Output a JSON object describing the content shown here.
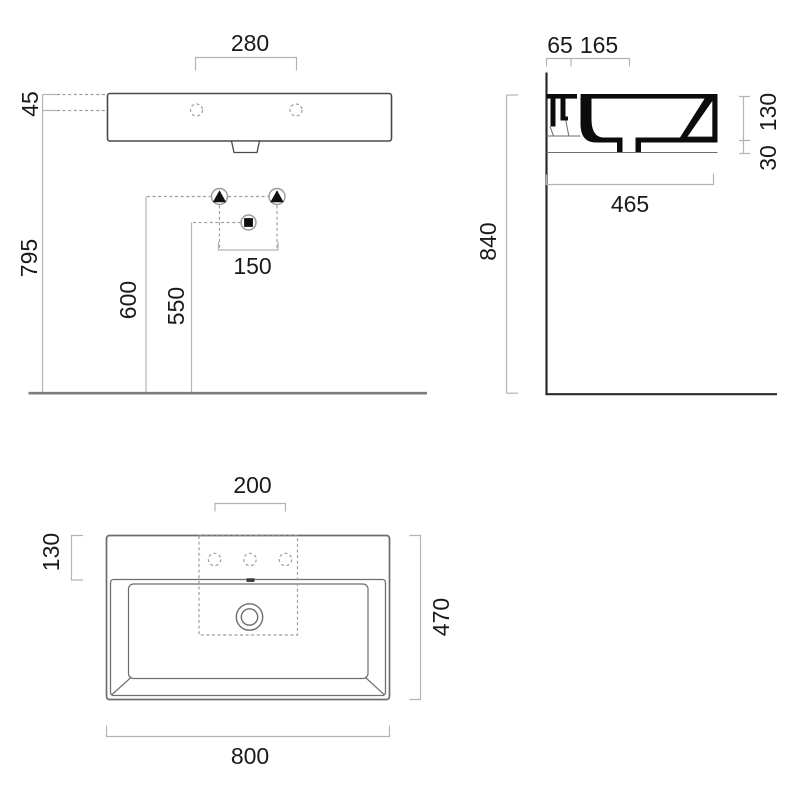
{
  "drawing_title": "washbasin-technical-drawing",
  "views": {
    "front": {
      "dims": {
        "tap_hole_spacing": "280",
        "deck_to_holes": "45",
        "holes_height": "795",
        "fixing_height": "600",
        "drain_height": "550",
        "fixing_spacing": "150"
      }
    },
    "side": {
      "dims": {
        "back_ledge": "65",
        "ledge_depth": "165",
        "body_height": "130",
        "lip_height": "30",
        "depth": "465",
        "rim_height": "840"
      }
    },
    "plan": {
      "dims": {
        "tap_zone_width": "200",
        "deck_depth": "130",
        "total_depth": "470",
        "total_width": "800"
      }
    }
  },
  "colors": {
    "outline": "#4a4a4a",
    "section_fill": "#0c0c0c",
    "dimension_line": "#b3b3b3",
    "text": "#1a1a1a",
    "floor_line": "#7d7d7d",
    "wall_line": "#2b2b2b"
  }
}
